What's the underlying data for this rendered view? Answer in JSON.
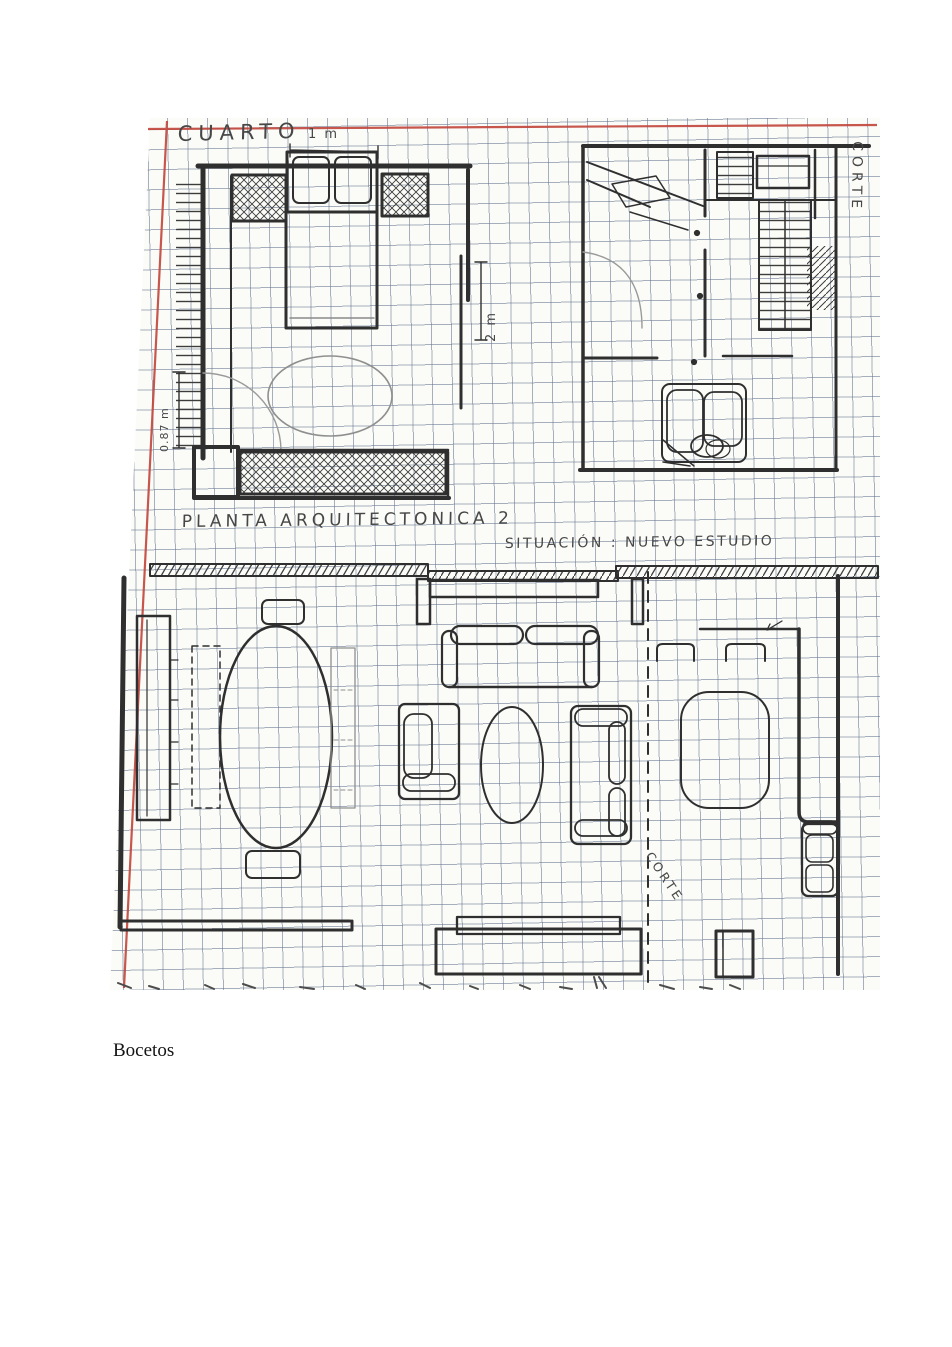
{
  "page": {
    "caption": "Bocetos"
  },
  "sketch": {
    "bedroom_plan": {
      "room_label": "CUARTO",
      "title": "PLANTA ARQUITECTONICA 2",
      "dim_top": "1 m",
      "dim_right": "2 m",
      "dim_left": "0.87 m"
    },
    "stairs_plan": {
      "section_label": "CORTE"
    },
    "studio_plan": {
      "title": "SITUACIÓN : NUEVO ESTUDIO",
      "section_label": "CORTE"
    },
    "colors": {
      "grid_line": "#60708c",
      "margin_line": "#c2453a",
      "ink": "#2f2f2f",
      "paper": "#fbfbf8"
    }
  }
}
